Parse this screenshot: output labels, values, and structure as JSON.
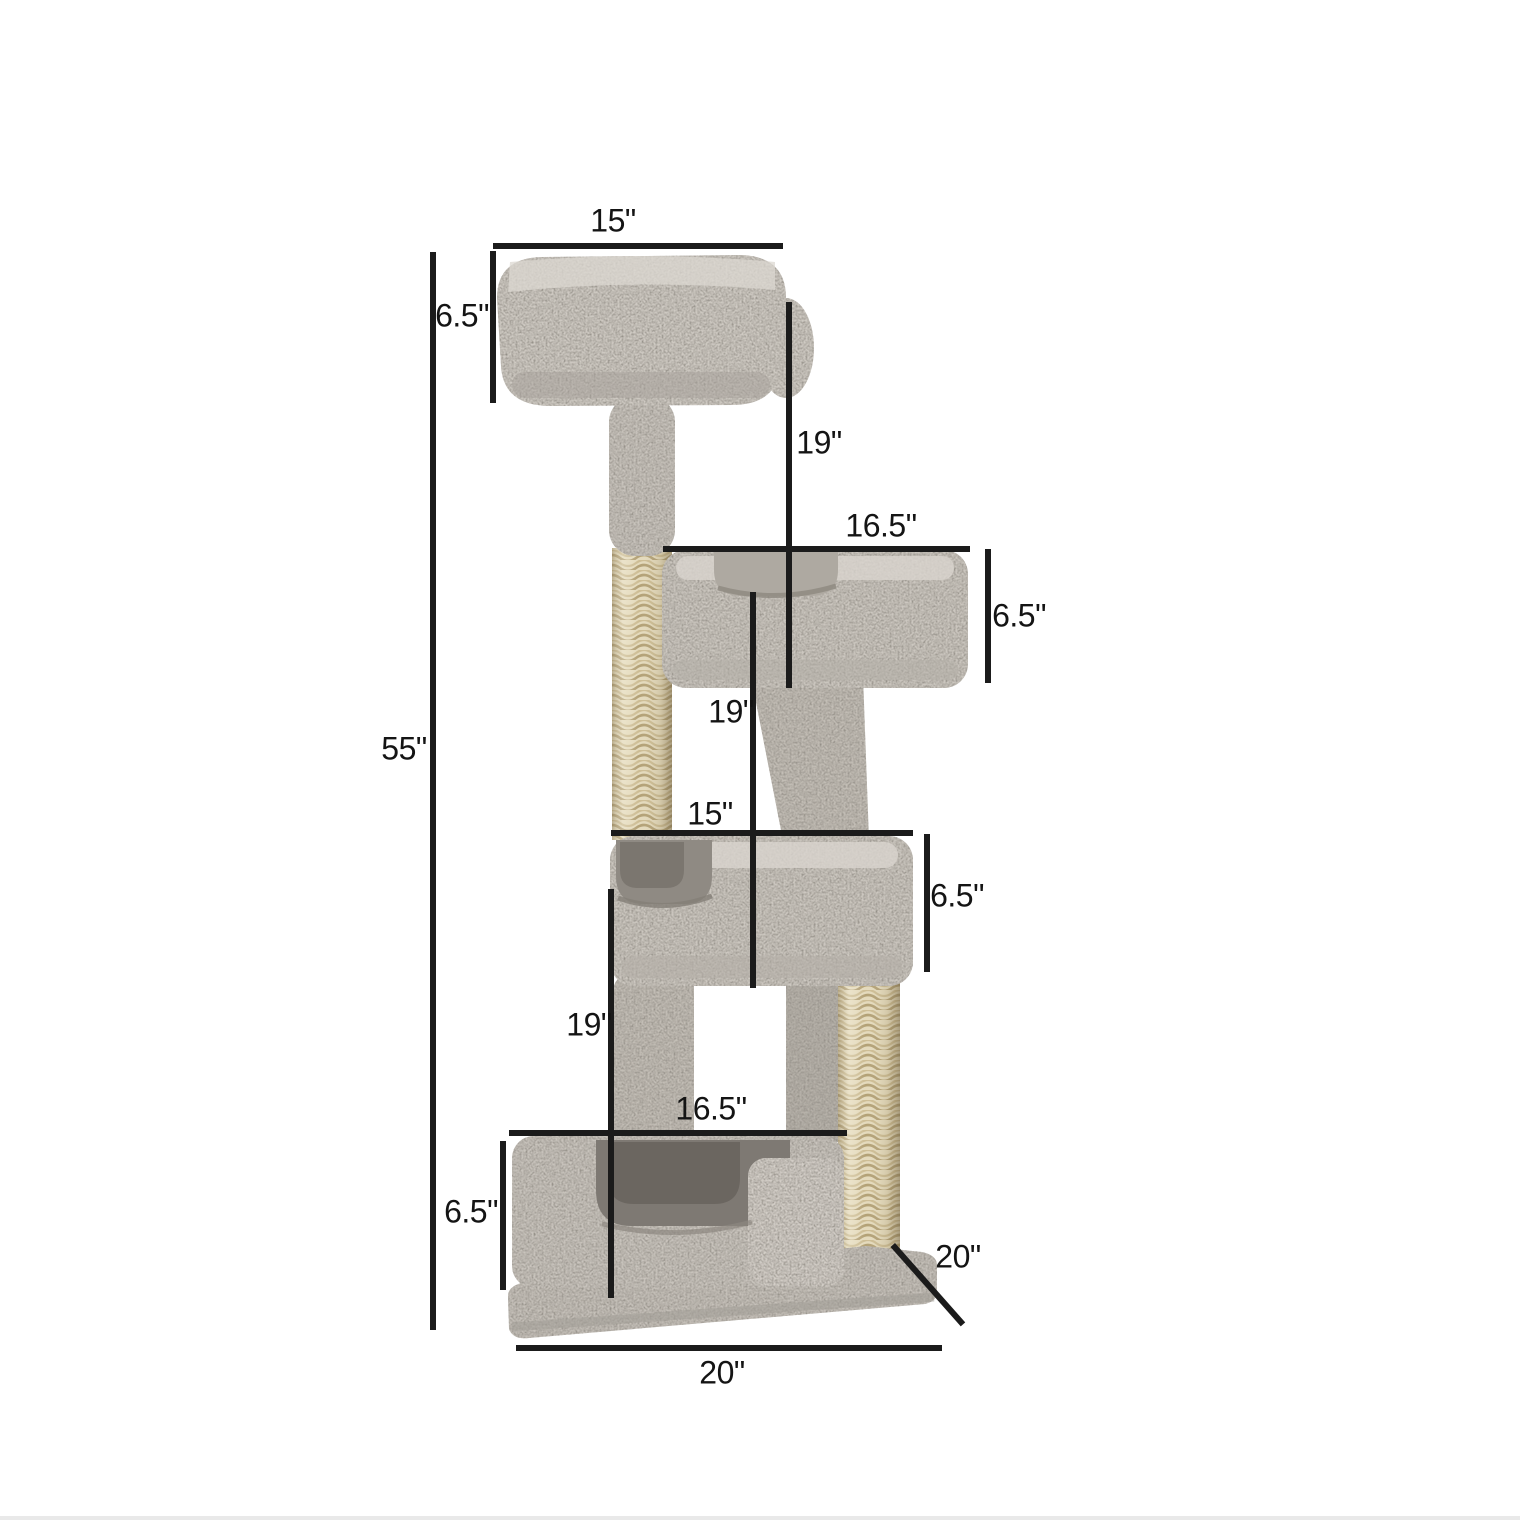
{
  "figure": {
    "type": "product-dimension-diagram",
    "subject": "four-level carpeted cat tree with sisal scratching posts, perch beds and base",
    "units": "inches"
  },
  "labels": {
    "top_bed_width": "15\"",
    "top_bed_height": "6.5\"",
    "top_gap_height": "19\"",
    "upper_bed_width": "16.5\"",
    "upper_bed_height": "6.5\"",
    "middle_gap_height": "19\"",
    "middle_bed_width": "15\"",
    "middle_bed_height": "6.5\"",
    "lower_gap_height": "19\"",
    "bottom_bed_width": "16.5\"",
    "bottom_bed_height": "6.5\"",
    "total_height": "55\"",
    "base_depth": "20\"",
    "base_width": "20\""
  },
  "colors": {
    "background": "#ffffff",
    "dimension_line": "#1b1b1b",
    "label_text": "#141414",
    "carpet": "#cac5be",
    "carpet_shadow": "#8a857e",
    "bed_interior": "#7e7973",
    "sisal": "#e4dabc"
  }
}
